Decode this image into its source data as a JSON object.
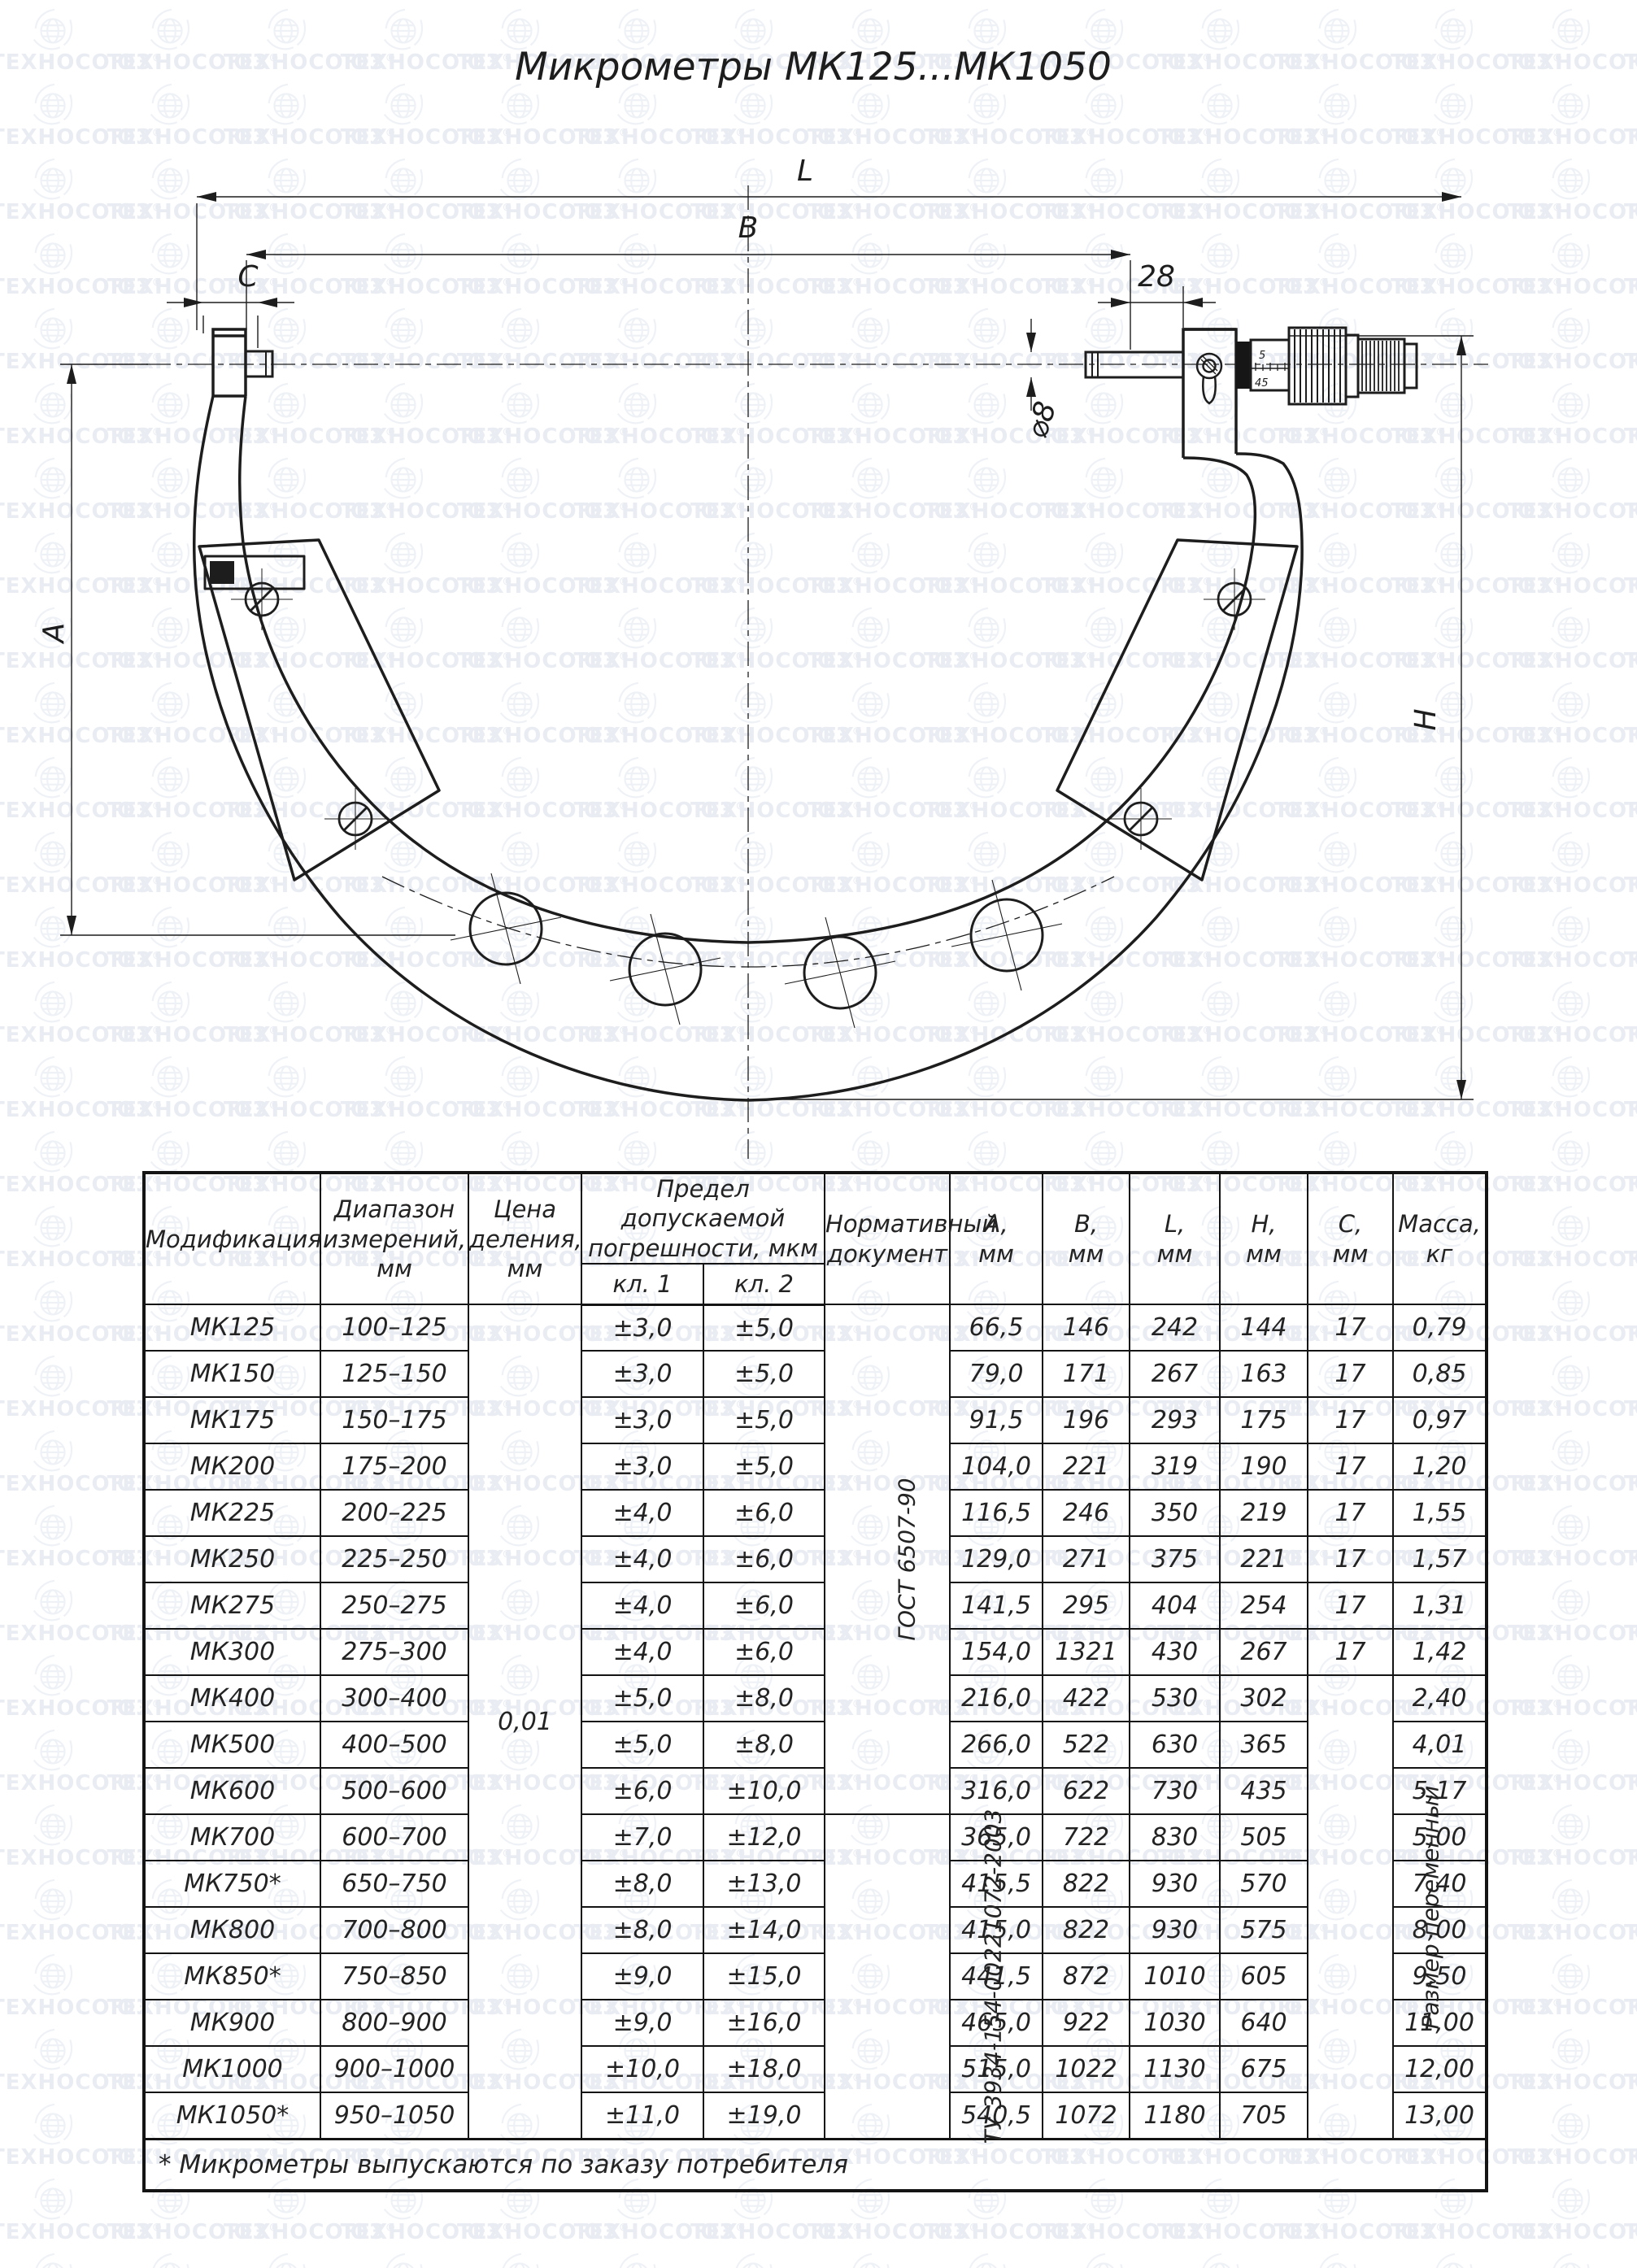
{
  "watermark": {
    "text": "ТЕХНОСОЮЗ",
    "registered": "®"
  },
  "title": "Микрометры МК125...МК1050",
  "drawing": {
    "dim_labels": {
      "L": "L",
      "B": "B",
      "C": "C",
      "len28": "28",
      "dia8": "⌀8",
      "A": "A",
      "H": "H"
    },
    "sleeve_marks": {
      "top": "5",
      "bottom": "45"
    }
  },
  "table": {
    "header": {
      "modification": "Модификация",
      "range": "Диапазон\nизмерений,\nмм",
      "division": "Цена\nделения,\nмм",
      "error_limit": "Предел допускаемой\nпогрешности, мкм",
      "class1": "кл. 1",
      "class2": "кл. 2",
      "document": "Нормативный\nдокумент",
      "a": "А,\nмм",
      "b": "В,\nмм",
      "l": "L,\nмм",
      "h": "Н,\nмм",
      "c": "С,\nмм",
      "mass": "Масса,\nкг"
    },
    "shared": {
      "division_value": "0,01",
      "doc1": "ГОСТ 6507-90",
      "doc1_rows": 11,
      "doc2": "ТУ 3934-154-00221072-2003",
      "doc2_rows": 7,
      "c_merged": "Размер переменный",
      "c_merged_rows": 10
    },
    "rows": [
      {
        "mod": "МК125",
        "range": "100–125",
        "kl1": "±3,0",
        "kl2": "±5,0",
        "a": "66,5",
        "b": "146",
        "l": "242",
        "h": "144",
        "c": "17",
        "mass": "0,79"
      },
      {
        "mod": "МК150",
        "range": "125–150",
        "kl1": "±3,0",
        "kl2": "±5,0",
        "a": "79,0",
        "b": "171",
        "l": "267",
        "h": "163",
        "c": "17",
        "mass": "0,85"
      },
      {
        "mod": "МК175",
        "range": "150–175",
        "kl1": "±3,0",
        "kl2": "±5,0",
        "a": "91,5",
        "b": "196",
        "l": "293",
        "h": "175",
        "c": "17",
        "mass": "0,97"
      },
      {
        "mod": "МК200",
        "range": "175–200",
        "kl1": "±3,0",
        "kl2": "±5,0",
        "a": "104,0",
        "b": "221",
        "l": "319",
        "h": "190",
        "c": "17",
        "mass": "1,20"
      },
      {
        "mod": "МК225",
        "range": "200–225",
        "kl1": "±4,0",
        "kl2": "±6,0",
        "a": "116,5",
        "b": "246",
        "l": "350",
        "h": "219",
        "c": "17",
        "mass": "1,55"
      },
      {
        "mod": "МК250",
        "range": "225–250",
        "kl1": "±4,0",
        "kl2": "±6,0",
        "a": "129,0",
        "b": "271",
        "l": "375",
        "h": "221",
        "c": "17",
        "mass": "1,57"
      },
      {
        "mod": "МК275",
        "range": "250–275",
        "kl1": "±4,0",
        "kl2": "±6,0",
        "a": "141,5",
        "b": "295",
        "l": "404",
        "h": "254",
        "c": "17",
        "mass": "1,31"
      },
      {
        "mod": "МК300",
        "range": "275–300",
        "kl1": "±4,0",
        "kl2": "±6,0",
        "a": "154,0",
        "b": "1321",
        "l": "430",
        "h": "267",
        "c": "17",
        "mass": "1,42"
      },
      {
        "mod": "МК400",
        "range": "300–400",
        "kl1": "±5,0",
        "kl2": "±8,0",
        "a": "216,0",
        "b": "422",
        "l": "530",
        "h": "302",
        "c": null,
        "mass": "2,40"
      },
      {
        "mod": "МК500",
        "range": "400–500",
        "kl1": "±5,0",
        "kl2": "±8,0",
        "a": "266,0",
        "b": "522",
        "l": "630",
        "h": "365",
        "c": null,
        "mass": "4,01"
      },
      {
        "mod": "МК600",
        "range": "500–600",
        "kl1": "±6,0",
        "kl2": "±10,0",
        "a": "316,0",
        "b": "622",
        "l": "730",
        "h": "435",
        "c": null,
        "mass": "5,17"
      },
      {
        "mod": "МК700",
        "range": "600–700",
        "kl1": "±7,0",
        "kl2": "±12,0",
        "a": "365,0",
        "b": "722",
        "l": "830",
        "h": "505",
        "c": null,
        "mass": "5,00"
      },
      {
        "mod": "МК750*",
        "range": "650–750",
        "kl1": "±8,0",
        "kl2": "±13,0",
        "a": "415,5",
        "b": "822",
        "l": "930",
        "h": "570",
        "c": null,
        "mass": "7,40"
      },
      {
        "mod": "МК800",
        "range": "700–800",
        "kl1": "±8,0",
        "kl2": "±14,0",
        "a": "415,0",
        "b": "822",
        "l": "930",
        "h": "575",
        "c": null,
        "mass": "8,00"
      },
      {
        "mod": "МК850*",
        "range": "750–850",
        "kl1": "±9,0",
        "kl2": "±15,0",
        "a": "441,5",
        "b": "872",
        "l": "1010",
        "h": "605",
        "c": null,
        "mass": "9,50"
      },
      {
        "mod": "МК900",
        "range": "800–900",
        "kl1": "±9,0",
        "kl2": "±16,0",
        "a": "465,0",
        "b": "922",
        "l": "1030",
        "h": "640",
        "c": null,
        "mass": "11,00"
      },
      {
        "mod": "МК1000",
        "range": "900–1000",
        "kl1": "±10,0",
        "kl2": "±18,0",
        "a": "515,0",
        "b": "1022",
        "l": "1130",
        "h": "675",
        "c": null,
        "mass": "12,00"
      },
      {
        "mod": "МК1050*",
        "range": "950–1050",
        "kl1": "±11,0",
        "kl2": "±19,0",
        "a": "540,5",
        "b": "1072",
        "l": "1180",
        "h": "705",
        "c": null,
        "mass": "13,00"
      }
    ],
    "footnote": "* Микрометры выпускаются по заказу потребителя"
  }
}
